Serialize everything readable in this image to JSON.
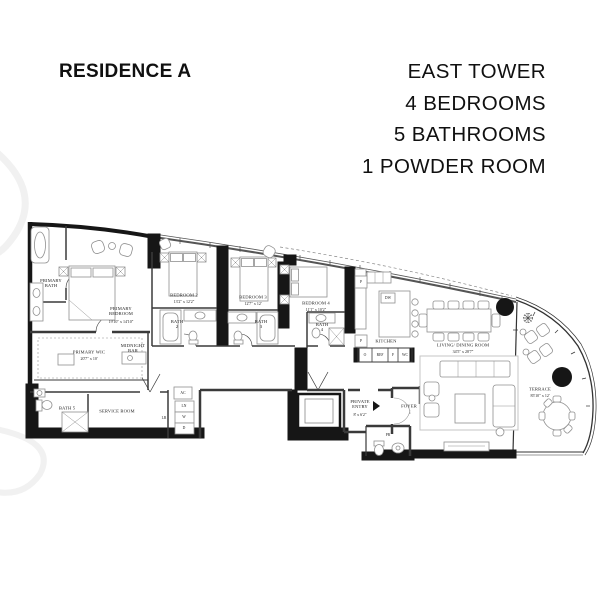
{
  "header": {
    "residence": "RESIDENCE A",
    "tower": "EAST TOWER",
    "bedrooms": "4 BEDROOMS",
    "bathrooms": "5 BATHROOMS",
    "powder": "1 POWDER ROOM"
  },
  "rooms": {
    "primary_bath": {
      "name": "PRIMARY BATH"
    },
    "primary_bedroom": {
      "name": "PRIMARY BEDROOM",
      "dim": "19'10\" x 14'10\""
    },
    "bedroom_2": {
      "name": "BEDROOM 2",
      "dim": "13'2\" x 12'2\""
    },
    "bedroom_3": {
      "name": "BEDROOM 3",
      "dim": "12'7\" x 12'"
    },
    "bedroom_4": {
      "name": "BEDROOM 4",
      "dim": "11'1\" x 10'2\""
    },
    "bath_2": {
      "name": "BATH 2"
    },
    "bath_3": {
      "name": "BATH 3"
    },
    "bath_4": {
      "name": "BATH 4"
    },
    "bath_5": {
      "name": "BATH 5"
    },
    "primary_wic": {
      "name": "PRIMARY WIC",
      "dim": "20'7\" x 10'"
    },
    "midnight_bar": {
      "name": "MIDNIGHT BAR"
    },
    "service_room": {
      "name": "SERVICE ROOM"
    },
    "kitchen": {
      "name": "KITCHEN"
    },
    "living_dining": {
      "name": "LIVING/ DINING ROOM",
      "dim": "34'5\" x 28'7\""
    },
    "private_entry": {
      "name": "PRIVATE ENTRY",
      "dim": "8' x 6'2\""
    },
    "foyer": {
      "name": "FOYER"
    },
    "powder_room": {
      "name": "PR"
    },
    "terrace": {
      "name": "TERRACE",
      "dim": "85'10\" x 12'"
    }
  },
  "fixtures": {
    "dw": "DW",
    "oven": "O",
    "ref": "REF",
    "freezer": "F",
    "wc": "WC",
    "pantry_1": "P",
    "pantry_2": "P",
    "ac": "AC",
    "linen": "LN",
    "washer": "W",
    "dryer": "D",
    "lr": "LR"
  },
  "colors": {
    "wall": "#161616",
    "thin_line": "#3a3a3a",
    "furniture": "#909090"
  }
}
